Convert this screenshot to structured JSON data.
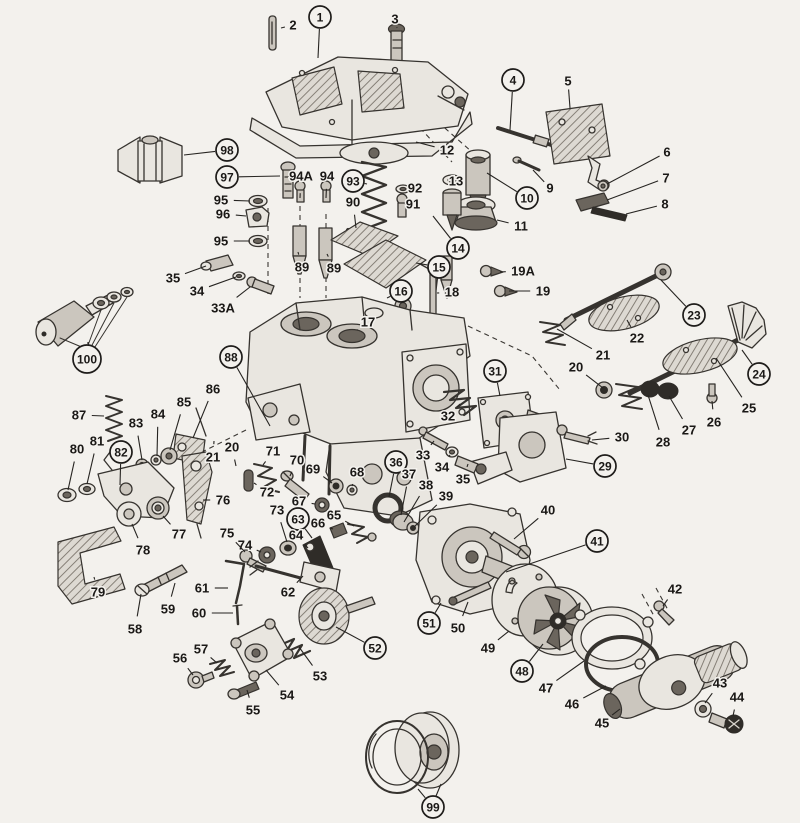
{
  "figure": {
    "description": "Exploded parts diagram of a carburetor with numbered callouts",
    "ink_color": "#36332f",
    "paper_color": "#f3f1ed"
  },
  "callouts": [
    {
      "label": "1",
      "x": 320,
      "y": 17,
      "circled": true,
      "tx": 318,
      "ty": 58
    },
    {
      "label": "2",
      "x": 293,
      "y": 25,
      "circled": false,
      "tx": 281,
      "ty": 28
    },
    {
      "label": "3",
      "x": 395,
      "y": 19,
      "circled": false,
      "tx": 397,
      "ty": 28
    },
    {
      "label": "4",
      "x": 513,
      "y": 80,
      "circled": true,
      "tx": 510,
      "ty": 130
    },
    {
      "label": "5",
      "x": 568,
      "y": 81,
      "circled": false,
      "tx": 570,
      "ty": 108
    },
    {
      "label": "6",
      "x": 667,
      "y": 152,
      "circled": false,
      "tx": 607,
      "ty": 184
    },
    {
      "label": "7",
      "x": 666,
      "y": 178,
      "circled": false,
      "tx": 607,
      "ty": 200
    },
    {
      "label": "8",
      "x": 665,
      "y": 204,
      "circled": false,
      "tx": 626,
      "ty": 214
    },
    {
      "label": "9",
      "x": 550,
      "y": 188,
      "circled": false,
      "tx": 533,
      "ty": 170
    },
    {
      "label": "10",
      "x": 527,
      "y": 198,
      "circled": true,
      "tx": 487,
      "ty": 173
    },
    {
      "label": "11",
      "x": 521,
      "y": 226,
      "circled": false,
      "tx": 497,
      "ty": 220
    },
    {
      "label": "12",
      "x": 447,
      "y": 150,
      "circled": false,
      "tx": 416,
      "ty": 142
    },
    {
      "label": "13",
      "x": 456,
      "y": 181,
      "circled": false,
      "tx": 462,
      "ty": 181
    },
    {
      "label": "14",
      "x": 458,
      "y": 248,
      "circled": true,
      "tx": 433,
      "ty": 216
    },
    {
      "label": "15",
      "x": 439,
      "y": 267,
      "circled": true,
      "tx": 416,
      "ty": 263
    },
    {
      "label": "16",
      "x": 401,
      "y": 291,
      "circled": true,
      "tx": 387,
      "ty": 298
    },
    {
      "label": "17",
      "x": 368,
      "y": 322,
      "circled": false,
      "tx": 357,
      "ty": 330
    },
    {
      "label": "18",
      "x": 452,
      "y": 292,
      "circled": false,
      "tx": 437,
      "ty": 293
    },
    {
      "label": "19",
      "x": 543,
      "y": 291,
      "circled": false,
      "tx": 509,
      "ty": 291
    },
    {
      "label": "19A",
      "x": 523,
      "y": 271,
      "circled": false,
      "tx": 500,
      "ty": 272
    },
    {
      "label": "20",
      "x": 576,
      "y": 367,
      "circled": false,
      "tx": 603,
      "ty": 388
    },
    {
      "label": "21",
      "x": 603,
      "y": 355,
      "circled": false,
      "tx": 557,
      "ty": 329
    },
    {
      "label": "22",
      "x": 637,
      "y": 338,
      "circled": false,
      "tx": 627,
      "ty": 320
    },
    {
      "label": "23",
      "x": 694,
      "y": 315,
      "circled": true,
      "tx": 661,
      "ty": 280
    },
    {
      "label": "24",
      "x": 759,
      "y": 374,
      "circled": true,
      "tx": 742,
      "ty": 350
    },
    {
      "label": "25",
      "x": 749,
      "y": 408,
      "circled": false,
      "tx": 716,
      "ty": 358
    },
    {
      "label": "26",
      "x": 714,
      "y": 422,
      "circled": false,
      "tx": 712,
      "ty": 401
    },
    {
      "label": "27",
      "x": 689,
      "y": 430,
      "circled": false,
      "tx": 669,
      "ty": 396
    },
    {
      "label": "28",
      "x": 663,
      "y": 442,
      "circled": false,
      "tx": 648,
      "ty": 395
    },
    {
      "label": "29",
      "x": 605,
      "y": 466,
      "circled": true,
      "tx": 566,
      "ty": 459
    },
    {
      "label": "30",
      "x": 622,
      "y": 437,
      "circled": false,
      "tx": 592,
      "ty": 440
    },
    {
      "label": "31",
      "x": 495,
      "y": 371,
      "circled": true,
      "tx": 500,
      "ty": 396
    },
    {
      "label": "32",
      "x": 448,
      "y": 416,
      "circled": false,
      "tx": 460,
      "ty": 404
    },
    {
      "label": "33",
      "x": 423,
      "y": 455,
      "circled": false,
      "tx": 434,
      "ty": 441
    },
    {
      "label": "34",
      "x": 442,
      "y": 467,
      "circled": false,
      "tx": 450,
      "ty": 455
    },
    {
      "label": "35",
      "x": 463,
      "y": 479,
      "circled": false,
      "tx": 468,
      "ty": 464
    },
    {
      "label": "36",
      "x": 396,
      "y": 462,
      "circled": true,
      "tx": 389,
      "ty": 497
    },
    {
      "label": "37",
      "x": 409,
      "y": 474,
      "circled": false,
      "tx": 401,
      "ty": 515
    },
    {
      "label": "38",
      "x": 426,
      "y": 485,
      "circled": false,
      "tx": 404,
      "ty": 522
    },
    {
      "label": "39",
      "x": 446,
      "y": 496,
      "circled": false,
      "tx": 414,
      "ty": 527
    },
    {
      "label": "40",
      "x": 548,
      "y": 510,
      "circled": false,
      "tx": 514,
      "ty": 539
    },
    {
      "label": "41",
      "x": 597,
      "y": 541,
      "circled": true,
      "tx": 506,
      "ty": 572
    },
    {
      "label": "42",
      "x": 675,
      "y": 589,
      "circled": false,
      "tx": 663,
      "ty": 606
    },
    {
      "label": "43",
      "x": 720,
      "y": 683,
      "circled": false,
      "tx": 705,
      "ty": 703
    },
    {
      "label": "44",
      "x": 737,
      "y": 697,
      "circled": false,
      "tx": 733,
      "ty": 716
    },
    {
      "label": "45",
      "x": 602,
      "y": 723,
      "circled": false,
      "tx": 620,
      "ty": 709
    },
    {
      "label": "46",
      "x": 572,
      "y": 704,
      "circled": false,
      "tx": 606,
      "ty": 686
    },
    {
      "label": "47",
      "x": 546,
      "y": 688,
      "circled": false,
      "tx": 584,
      "ty": 661
    },
    {
      "label": "48",
      "x": 522,
      "y": 671,
      "circled": true,
      "tx": 543,
      "ty": 644
    },
    {
      "label": "49",
      "x": 488,
      "y": 648,
      "circled": false,
      "tx": 509,
      "ty": 631
    },
    {
      "label": "50",
      "x": 458,
      "y": 628,
      "circled": false,
      "tx": 468,
      "ty": 602
    },
    {
      "label": "51",
      "x": 429,
      "y": 623,
      "circled": true,
      "tx": 441,
      "ty": 603
    },
    {
      "label": "52",
      "x": 375,
      "y": 648,
      "circled": true,
      "tx": 336,
      "ty": 627
    },
    {
      "label": "53",
      "x": 320,
      "y": 676,
      "circled": false,
      "tx": 299,
      "ty": 647
    },
    {
      "label": "54",
      "x": 287,
      "y": 695,
      "circled": false,
      "tx": 266,
      "ty": 670
    },
    {
      "label": "55",
      "x": 253,
      "y": 710,
      "circled": false,
      "tx": 247,
      "ty": 690
    },
    {
      "label": "56",
      "x": 180,
      "y": 658,
      "circled": false,
      "tx": 193,
      "ty": 675
    },
    {
      "label": "57",
      "x": 201,
      "y": 649,
      "circled": false,
      "tx": 217,
      "ty": 663
    },
    {
      "label": "58",
      "x": 135,
      "y": 629,
      "circled": false,
      "tx": 141,
      "ty": 594
    },
    {
      "label": "59",
      "x": 168,
      "y": 609,
      "circled": false,
      "tx": 175,
      "ty": 583
    },
    {
      "label": "60",
      "x": 199,
      "y": 613,
      "circled": false,
      "tx": 233,
      "ty": 613
    },
    {
      "label": "61",
      "x": 202,
      "y": 588,
      "circled": false,
      "tx": 228,
      "ty": 588
    },
    {
      "label": "62",
      "x": 288,
      "y": 592,
      "circled": false,
      "tx": 303,
      "ty": 576
    },
    {
      "label": "63",
      "x": 298,
      "y": 519,
      "circled": true,
      "tx": 312,
      "ty": 538
    },
    {
      "label": "64",
      "x": 296,
      "y": 535,
      "circled": false,
      "tx": 308,
      "ty": 548
    },
    {
      "label": "65",
      "x": 334,
      "y": 515,
      "circled": false,
      "tx": 354,
      "ty": 526
    },
    {
      "label": "66",
      "x": 318,
      "y": 523,
      "circled": false,
      "tx": 333,
      "ty": 529
    },
    {
      "label": "67",
      "x": 299,
      "y": 501,
      "circled": false,
      "tx": 315,
      "ty": 504
    },
    {
      "label": "68",
      "x": 357,
      "y": 472,
      "circled": false,
      "tx": 352,
      "ty": 486
    },
    {
      "label": "69",
      "x": 313,
      "y": 469,
      "circled": false,
      "tx": 332,
      "ty": 483
    },
    {
      "label": "70",
      "x": 297,
      "y": 460,
      "circled": false,
      "tx": 290,
      "ty": 476
    },
    {
      "label": "71",
      "x": 273,
      "y": 451,
      "circled": false,
      "tx": 263,
      "ty": 465
    },
    {
      "label": "72",
      "x": 267,
      "y": 492,
      "circled": false,
      "tx": 254,
      "ty": 483
    },
    {
      "label": "73",
      "x": 277,
      "y": 510,
      "circled": false,
      "tx": 287,
      "ty": 542
    },
    {
      "label": "74",
      "x": 245,
      "y": 545,
      "circled": false,
      "tx": 261,
      "ty": 552
    },
    {
      "label": "75",
      "x": 227,
      "y": 533,
      "circled": false,
      "tx": 245,
      "ty": 552
    },
    {
      "label": "76",
      "x": 223,
      "y": 500,
      "circled": false,
      "tx": 203,
      "ty": 500
    },
    {
      "label": "77",
      "x": 179,
      "y": 534,
      "circled": false,
      "tx": 163,
      "ty": 516
    },
    {
      "label": "78",
      "x": 143,
      "y": 550,
      "circled": false,
      "tx": 132,
      "ty": 524
    },
    {
      "label": "79",
      "x": 98,
      "y": 592,
      "circled": false,
      "tx": 94,
      "ty": 577
    },
    {
      "label": "80",
      "x": 77,
      "y": 449,
      "circled": false,
      "tx": 68,
      "ty": 490
    },
    {
      "label": "81",
      "x": 97,
      "y": 441,
      "circled": false,
      "tx": 87,
      "ty": 484
    },
    {
      "label": "82",
      "x": 121,
      "y": 452,
      "circled": true,
      "tx": 120,
      "ty": 485
    },
    {
      "label": "83",
      "x": 136,
      "y": 423,
      "circled": false,
      "tx": 142,
      "ty": 460
    },
    {
      "label": "84",
      "x": 158,
      "y": 414,
      "circled": false,
      "tx": 157,
      "ty": 456
    },
    {
      "label": "85",
      "x": 184,
      "y": 402,
      "circled": false,
      "tx": 170,
      "ty": 450
    },
    {
      "label": "86",
      "x": 213,
      "y": 389,
      "circled": false,
      "tx": 193,
      "ty": 438
    },
    {
      "label": "87",
      "x": 79,
      "y": 415,
      "circled": false,
      "tx": 104,
      "ty": 416
    },
    {
      "label": "88",
      "x": 231,
      "y": 357,
      "circled": true,
      "tx": 270,
      "ty": 426
    },
    {
      "label": "89",
      "x": 302,
      "y": 267,
      "circled": false,
      "tx": 298,
      "ty": 252
    },
    {
      "label": "89",
      "x": 334,
      "y": 268,
      "circled": false,
      "tx": 327,
      "ty": 254
    },
    {
      "label": "90",
      "x": 353,
      "y": 202,
      "circled": false,
      "tx": 356,
      "ty": 228
    },
    {
      "label": "91",
      "x": 413,
      "y": 204,
      "circled": false,
      "tx": 406,
      "ty": 204
    },
    {
      "label": "92",
      "x": 415,
      "y": 188,
      "circled": false,
      "tx": 409,
      "ty": 189
    },
    {
      "label": "93",
      "x": 353,
      "y": 181,
      "circled": true,
      "tx": 367,
      "ty": 184
    },
    {
      "label": "94",
      "x": 327,
      "y": 176,
      "circled": false,
      "tx": 326,
      "ty": 198
    },
    {
      "label": "94A",
      "x": 301,
      "y": 176,
      "circled": false,
      "tx": 300,
      "ty": 198
    },
    {
      "label": "95",
      "x": 221,
      "y": 200,
      "circled": false,
      "tx": 250,
      "ty": 201
    },
    {
      "label": "96",
      "x": 223,
      "y": 214,
      "circled": false,
      "tx": 246,
      "ty": 216
    },
    {
      "label": "95",
      "x": 221,
      "y": 241,
      "circled": false,
      "tx": 250,
      "ty": 241
    },
    {
      "label": "97",
      "x": 227,
      "y": 177,
      "circled": true,
      "tx": 280,
      "ty": 176
    },
    {
      "label": "98",
      "x": 227,
      "y": 150,
      "circled": true,
      "tx": 184,
      "ty": 155
    },
    {
      "label": "99",
      "x": 433,
      "y": 807,
      "circled": true,
      "tx": 418,
      "ty": 789
    },
    {
      "label": "100",
      "x": 87,
      "y": 359,
      "circled": true,
      "tx": 88,
      "ty": 342
    },
    {
      "label": "33A",
      "x": 223,
      "y": 308,
      "circled": false,
      "tx": 250,
      "ty": 287
    },
    {
      "label": "34",
      "x": 197,
      "y": 291,
      "circled": false,
      "tx": 236,
      "ty": 277
    },
    {
      "label": "35",
      "x": 173,
      "y": 278,
      "circled": false,
      "tx": 206,
      "ty": 266
    },
    {
      "label": "20",
      "x": 232,
      "y": 447,
      "circled": false,
      "tx": 236,
      "ty": 466
    },
    {
      "label": "21",
      "x": 213,
      "y": 457,
      "circled": false,
      "tx": 214,
      "ty": 441
    }
  ]
}
